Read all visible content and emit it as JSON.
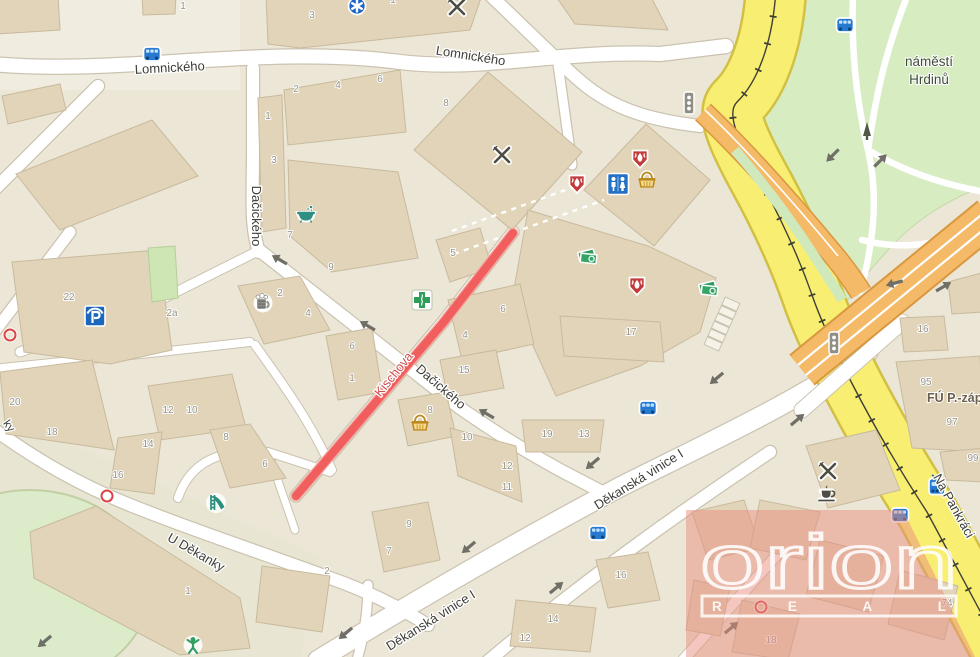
{
  "streets": {
    "lomnickeho": "Lomnického",
    "dacickeho": "Dačického",
    "kischova": "Kischova",
    "dekanska_vinice": "Děkanská vinice I",
    "u_dekanky": "U Děkanky",
    "na_pankraci": "Na Pankráci",
    "edge_partial": "ky"
  },
  "park": {
    "line1": "náměstí",
    "line2": "Hrdinů"
  },
  "office_label": "FÚ P.-západ",
  "watermark": {
    "brand": "orion",
    "sub": "R E A L"
  },
  "highlight": {
    "street": "Kischova",
    "color": "#f15e5e"
  },
  "colors": {
    "major_road": "#f8ef72",
    "secondary_road": "#f5ba68",
    "minor_road": "#ffffff",
    "park_green": "#d8ecc2",
    "building": "#e2d4b9",
    "highlight_red": "#f15e5e",
    "watermark_pink": "#e78e7f"
  },
  "house_numbers": [
    {
      "n": "1",
      "x": 183,
      "y": 9
    },
    {
      "n": "3",
      "x": 312,
      "y": 18
    },
    {
      "n": "1",
      "x": 393,
      "y": 3
    },
    {
      "n": "2",
      "x": 296,
      "y": 92
    },
    {
      "n": "4",
      "x": 338,
      "y": 88
    },
    {
      "n": "6",
      "x": 380,
      "y": 82
    },
    {
      "n": "8",
      "x": 446,
      "y": 106
    },
    {
      "n": "1",
      "x": 268,
      "y": 119
    },
    {
      "n": "3",
      "x": 274,
      "y": 163
    },
    {
      "n": "7",
      "x": 290,
      "y": 238
    },
    {
      "n": "9",
      "x": 331,
      "y": 270
    },
    {
      "n": "2",
      "x": 280,
      "y": 296
    },
    {
      "n": "4",
      "x": 308,
      "y": 316
    },
    {
      "n": "2a",
      "x": 172,
      "y": 316
    },
    {
      "n": "22",
      "x": 69,
      "y": 300
    },
    {
      "n": "20",
      "x": 15,
      "y": 405
    },
    {
      "n": "18",
      "x": 52,
      "y": 435
    },
    {
      "n": "12",
      "x": 168,
      "y": 413
    },
    {
      "n": "10",
      "x": 192,
      "y": 413
    },
    {
      "n": "14",
      "x": 148,
      "y": 447
    },
    {
      "n": "8",
      "x": 226,
      "y": 440
    },
    {
      "n": "6",
      "x": 265,
      "y": 467
    },
    {
      "n": "16",
      "x": 118,
      "y": 478
    },
    {
      "n": "5",
      "x": 453,
      "y": 256
    },
    {
      "n": "6",
      "x": 352,
      "y": 349
    },
    {
      "n": "1",
      "x": 352,
      "y": 381
    },
    {
      "n": "6",
      "x": 503,
      "y": 312
    },
    {
      "n": "4",
      "x": 465,
      "y": 338
    },
    {
      "n": "15",
      "x": 464,
      "y": 373
    },
    {
      "n": "8",
      "x": 430,
      "y": 413
    },
    {
      "n": "17",
      "x": 631,
      "y": 335
    },
    {
      "n": "19",
      "x": 547,
      "y": 437
    },
    {
      "n": "13",
      "x": 584,
      "y": 437
    },
    {
      "n": "10",
      "x": 467,
      "y": 440
    },
    {
      "n": "12",
      "x": 507,
      "y": 469
    },
    {
      "n": "11",
      "x": 507,
      "y": 490
    },
    {
      "n": "9",
      "x": 409,
      "y": 527
    },
    {
      "n": "7",
      "x": 389,
      "y": 554
    },
    {
      "n": "16",
      "x": 621,
      "y": 578
    },
    {
      "n": "14",
      "x": 553,
      "y": 622
    },
    {
      "n": "12",
      "x": 525,
      "y": 641
    },
    {
      "n": "2",
      "x": 327,
      "y": 574
    },
    {
      "n": "1",
      "x": 188,
      "y": 594
    },
    {
      "n": "16",
      "x": 923,
      "y": 332
    },
    {
      "n": "95",
      "x": 926,
      "y": 385
    },
    {
      "n": "97",
      "x": 952,
      "y": 425
    },
    {
      "n": "99",
      "x": 973,
      "y": 461
    },
    {
      "n": "74",
      "x": 947,
      "y": 606
    },
    {
      "n": "18",
      "x": 771,
      "y": 643
    }
  ],
  "icons": [
    {
      "type": "bus",
      "x": 152,
      "y": 54
    },
    {
      "type": "bus",
      "x": 845,
      "y": 25
    },
    {
      "type": "bus",
      "x": 648,
      "y": 408
    },
    {
      "type": "bus",
      "x": 598,
      "y": 533
    },
    {
      "type": "bus",
      "x": 900,
      "y": 515
    },
    {
      "type": "tram",
      "x": 937,
      "y": 487
    },
    {
      "type": "medical",
      "x": 357,
      "y": 6
    },
    {
      "type": "restaurant",
      "x": 457,
      "y": 7
    },
    {
      "type": "restaurant",
      "x": 502,
      "y": 155
    },
    {
      "type": "restaurant",
      "x": 828,
      "y": 471
    },
    {
      "type": "cafe",
      "x": 827,
      "y": 494
    },
    {
      "type": "wc",
      "x": 618,
      "y": 184
    },
    {
      "type": "basket",
      "x": 647,
      "y": 181
    },
    {
      "type": "basket",
      "x": 420,
      "y": 424
    },
    {
      "type": "flame",
      "x": 577,
      "y": 184
    },
    {
      "type": "flame",
      "x": 640,
      "y": 159
    },
    {
      "type": "flame",
      "x": 637,
      "y": 286
    },
    {
      "type": "money",
      "x": 587,
      "y": 257
    },
    {
      "type": "money",
      "x": 708,
      "y": 289
    },
    {
      "type": "pharmacy",
      "x": 422,
      "y": 300
    },
    {
      "type": "parking",
      "x": 95,
      "y": 316
    },
    {
      "type": "beer",
      "x": 263,
      "y": 303
    },
    {
      "type": "bath",
      "x": 306,
      "y": 214
    },
    {
      "type": "slide",
      "x": 216,
      "y": 503
    },
    {
      "type": "person",
      "x": 193,
      "y": 645
    },
    {
      "type": "tree",
      "x": 867,
      "y": 133
    },
    {
      "type": "light",
      "x": 689,
      "y": 103
    },
    {
      "type": "light",
      "x": 834,
      "y": 343
    },
    {
      "type": "gate",
      "x": 10,
      "y": 335
    },
    {
      "type": "gate",
      "x": 107,
      "y": 496
    },
    {
      "type": "gate",
      "x": 761,
      "y": 607
    },
    {
      "type": "steps",
      "x": 722,
      "y": 324,
      "rot": 24
    }
  ],
  "arrows": [
    {
      "x": 280,
      "y": 260,
      "r": -150
    },
    {
      "x": 368,
      "y": 326,
      "r": -150
    },
    {
      "x": 487,
      "y": 414,
      "r": -150
    },
    {
      "x": 833,
      "y": 155,
      "r": 135
    },
    {
      "x": 880,
      "y": 161,
      "r": -45
    },
    {
      "x": 895,
      "y": 283,
      "r": 165
    },
    {
      "x": 943,
      "y": 287,
      "r": -30
    },
    {
      "x": 593,
      "y": 463,
      "r": 140
    },
    {
      "x": 469,
      "y": 547,
      "r": 140
    },
    {
      "x": 717,
      "y": 378,
      "r": 140
    },
    {
      "x": 346,
      "y": 633,
      "r": 140
    },
    {
      "x": 45,
      "y": 641,
      "r": 140
    },
    {
      "x": 556,
      "y": 588,
      "r": -40
    },
    {
      "x": 797,
      "y": 420,
      "r": -40
    },
    {
      "x": 731,
      "y": 628,
      "r": -40
    }
  ]
}
